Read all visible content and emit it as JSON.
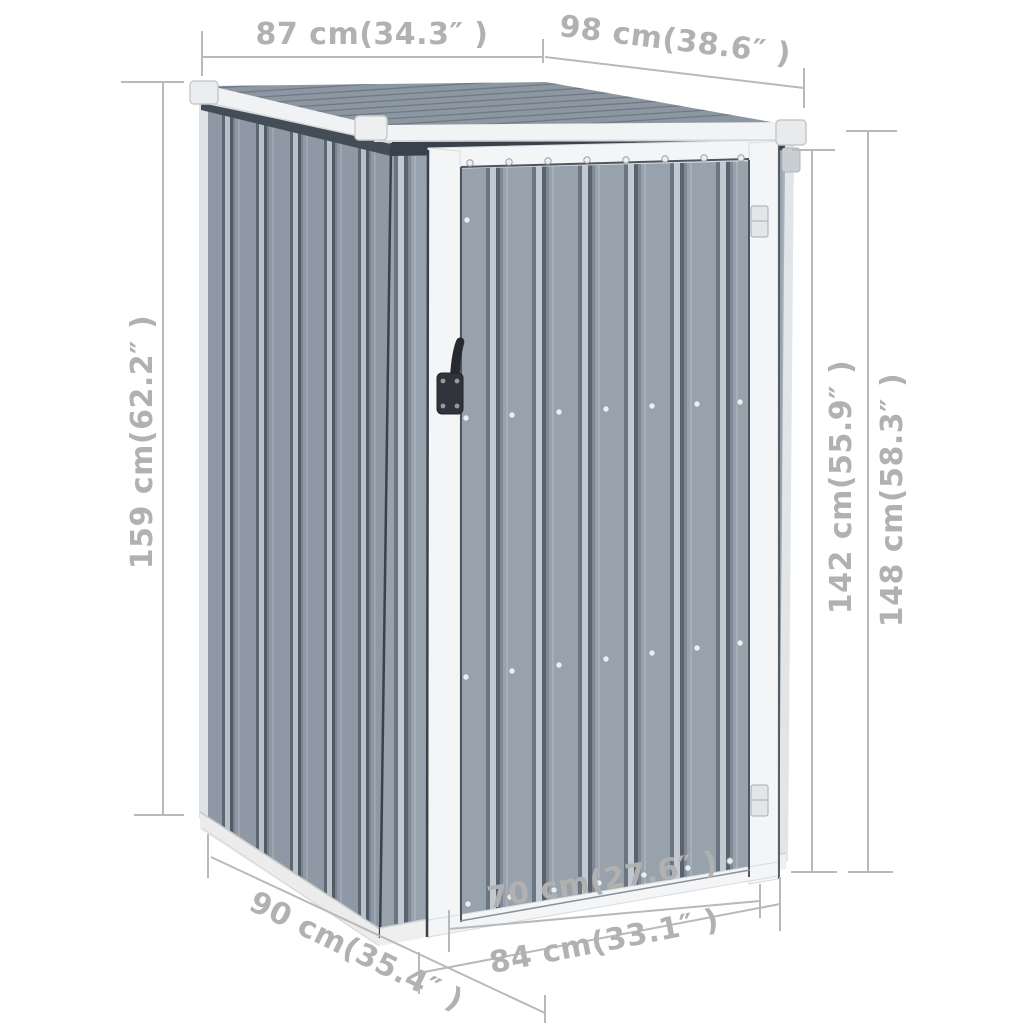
{
  "meta": {
    "type": "product-dimension-diagram",
    "subject": "Metal garden shed with pent roof and single hinged door, shown in 3/4 perspective on white background with gray dimension annotations"
  },
  "colors": {
    "background": "#ffffff",
    "annotation": "#b9b9b9",
    "annotation_text": "#b1b1b1",
    "wall_base": "#98a2ad",
    "wall_groove_dark": "#59636f",
    "wall_ridge_light": "#c2c9d1",
    "roof_surface": "#8d97a2",
    "roof_stripe": "#6f7a85",
    "trim_white": "#f2f3f4",
    "door_frame": "#f4f5f6",
    "base_rail": "#ececec",
    "handle_black": "#30343a",
    "shadow_band": "#39424c"
  },
  "dimensions": {
    "roof_side": {
      "label": "87 cm(34.3″ )"
    },
    "roof_front": {
      "label": "98 cm(38.6″ )"
    },
    "height_left": {
      "label": "159 cm(62.2″ )"
    },
    "height_front_right": {
      "label": "142 cm(55.9″ )"
    },
    "height_back_right": {
      "label": "148 cm(58.3″ )"
    },
    "base_side": {
      "label": "90 cm(35.4″ )"
    },
    "door_width": {
      "label": "70 cm(27.6″ )"
    },
    "base_front": {
      "label": "84 cm(33.1″ )"
    }
  }
}
